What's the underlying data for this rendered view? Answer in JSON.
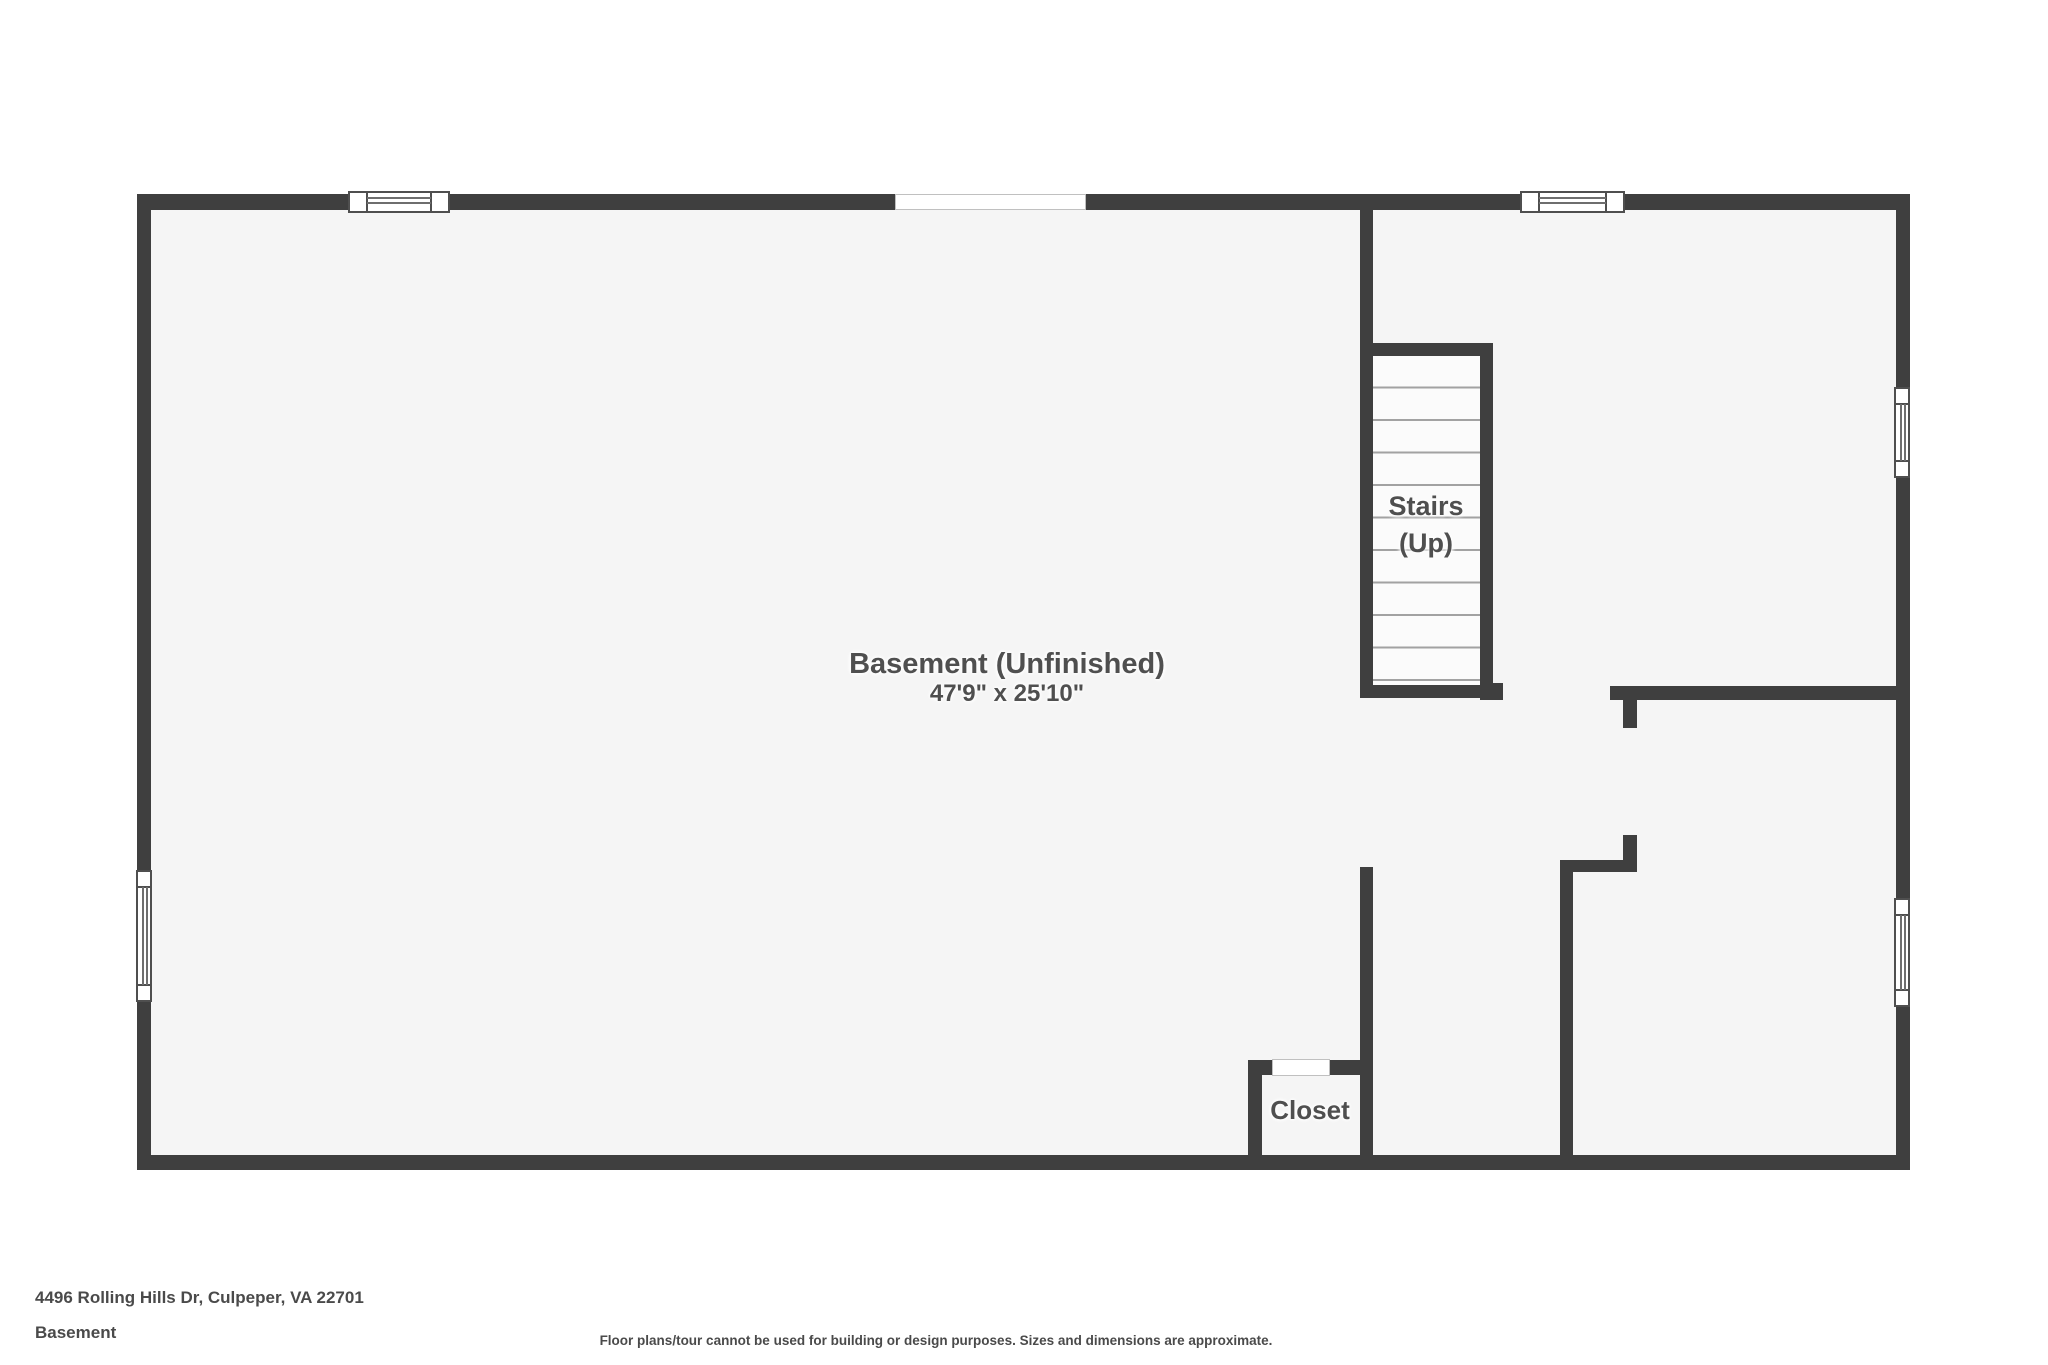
{
  "plan": {
    "basement_label": "Basement (Unfinished)",
    "basement_dimensions": "47'9\" x 25'10\"",
    "stairs_label_line1": "Stairs",
    "stairs_label_line2": "(Up)",
    "closet_label": "Closet"
  },
  "footer": {
    "address": "4496 Rolling Hills Dr, Culpeper, VA 22701",
    "floor_name": "Basement",
    "disclaimer": "Floor plans/tour cannot be used for building or design purposes. Sizes and dimensions are approximate."
  },
  "colors": {
    "wall": "#3f3f3f",
    "floor": "#f5f5f5",
    "stair-fill": "#fbfbfb",
    "tread-line": "#a2a2a2",
    "label-text": "#4f4f4f",
    "window-frame": "#4f4f4f",
    "opening-border": "#c0c0c0"
  }
}
